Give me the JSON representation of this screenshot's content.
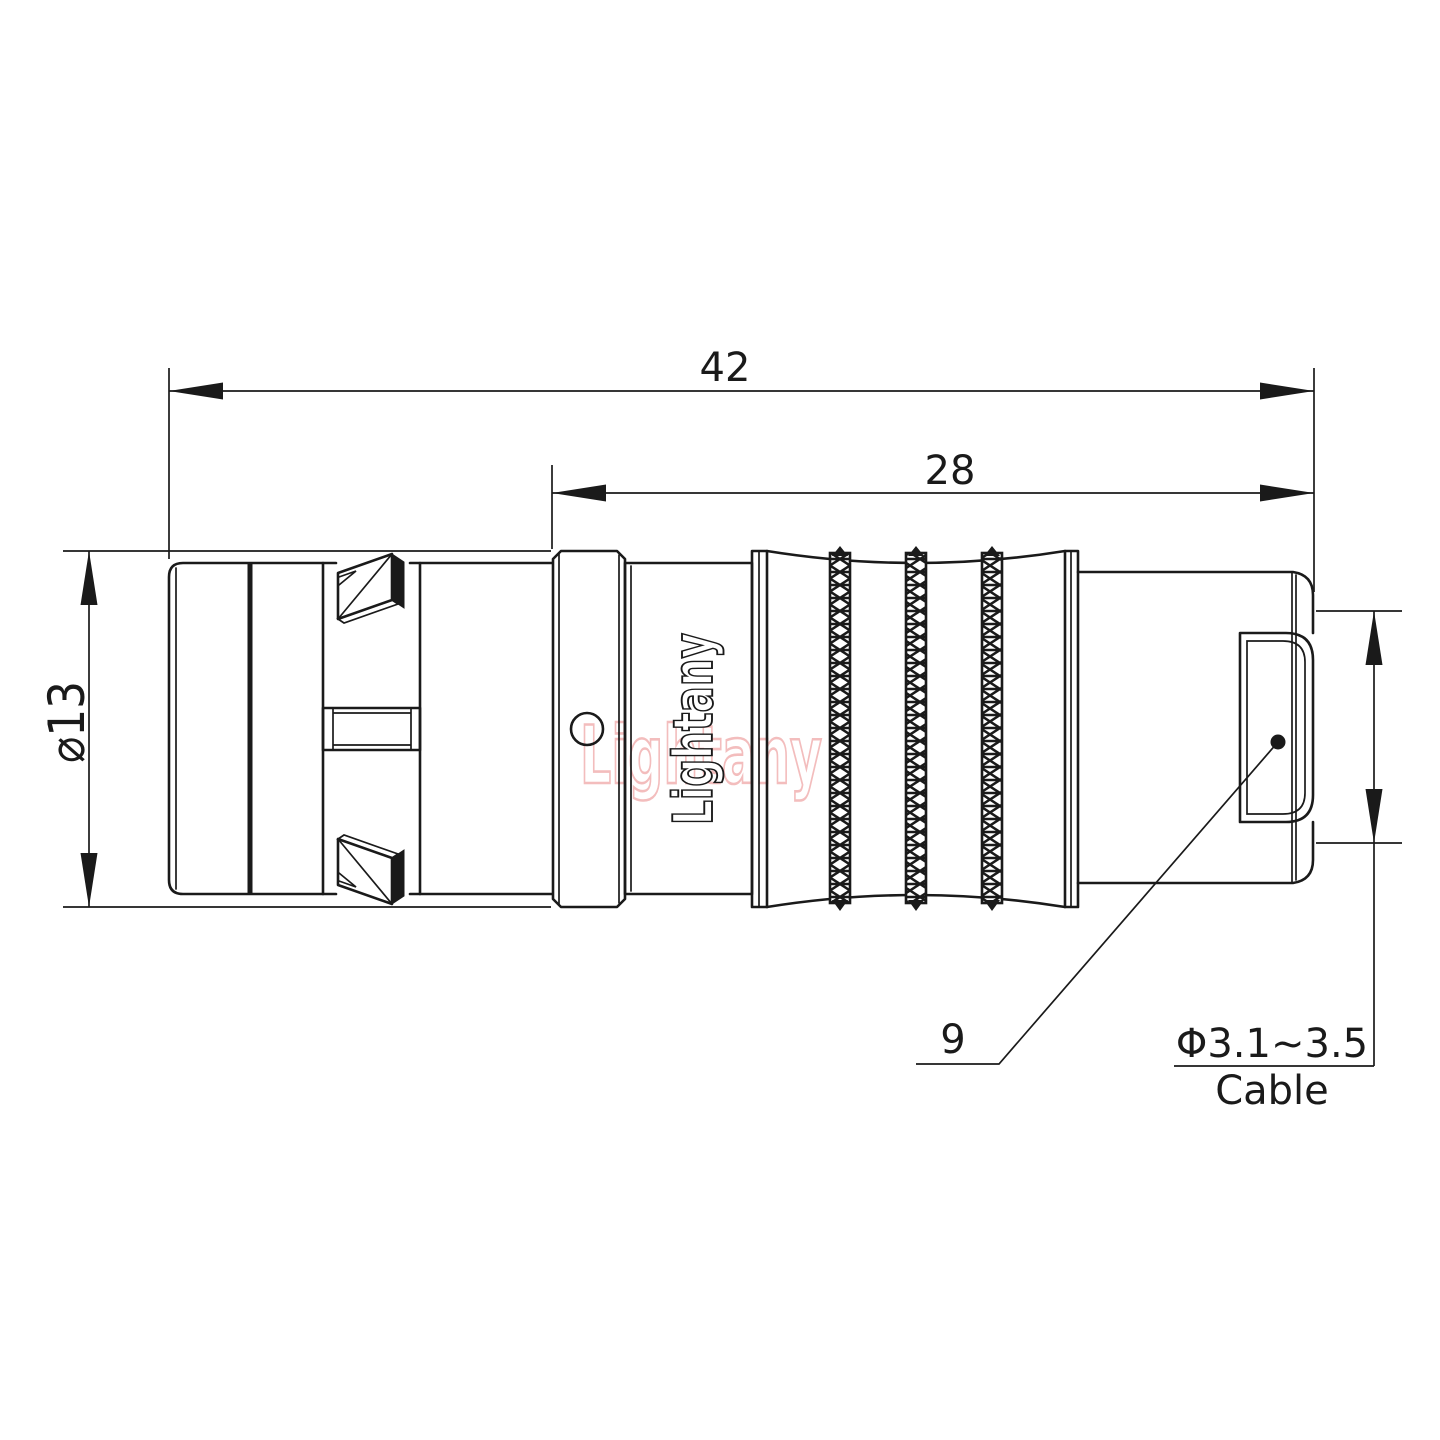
{
  "drawing": {
    "dims": {
      "overall_length": "42",
      "rear_length": "28",
      "body_diameter": "⌀13",
      "nut_size": "9",
      "cable_range": "Φ3.1~3.5",
      "cable_word": "Cable"
    },
    "brand": {
      "engraved_logo": "Lightany",
      "watermark": "Lightany"
    },
    "colors": {
      "line": "#1a1a1a",
      "watermark": "#f3bdbd",
      "background": "#ffffff"
    }
  }
}
